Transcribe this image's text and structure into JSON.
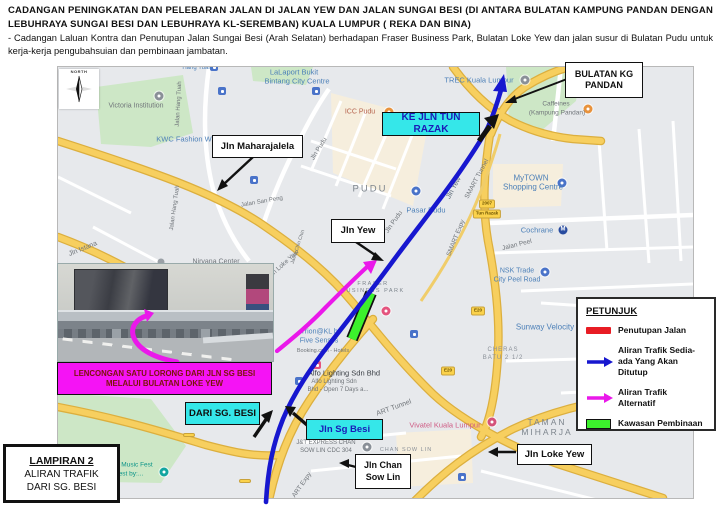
{
  "header": {
    "title": "CADANGAN PENINGKATAN DAN PELEBARAN JALAN DI JALAN YEW DAN JALAN SUNGAI BESI (DI ANTARA BULATAN KAMPUNG PANDAN DENGAN LEBUHRAYA SUNGAI BESI DAN LEBUHRAYA KL-SEREMBAN) KUALA LUMPUR ( REKA DAN BINA)",
    "subtitle": "- Cadangan Laluan Kontra dan Penutupan Jalan Sungai Besi (Arah Selatan) berhadapan Fraser Business Park, Bulatan Loke Yew dan jalan susur di Bulatan Pudu untuk kerja-kerja pengubahsuian dan pembinaan jambatan."
  },
  "callouts": {
    "bulatan_kg_pandan_l1": "BULATAN KG",
    "bulatan_kg_pandan_l2": "PANDAN",
    "ke_jln_tun_razak": "KE JLN TUN RAZAK",
    "jln_maharajalela": "Jln Maharajalela",
    "jln_yew": "Jln Yew",
    "lencongan_l1": "LENCONGAN SATU LORONG DARI JLN SG BESI",
    "lencongan_l2": "MELALUI BULATAN LOKE YEW",
    "dari_sg_besi": "DARI SG. BESI",
    "jln_sg_besi": "Jln Sg Besi",
    "jln_chan_sow_lin_l1": "Jln Chan",
    "jln_chan_sow_lin_l2": "Sow Lin",
    "jln_loke_yew": "Jln Loke Yew"
  },
  "legend": {
    "title": "PETUNJUK",
    "items": [
      {
        "symbol": "red-bar",
        "label": "Penutupan Jalan",
        "color": "#e81c24"
      },
      {
        "symbol": "blue-arrow",
        "label": "Aliran Trafik Sedia-ada Yang Akan Ditutup",
        "color": "#1717cf"
      },
      {
        "symbol": "magenta-arrow",
        "label": "Aliran Trafik Alternatif",
        "color": "#ea18ea"
      },
      {
        "symbol": "green-box",
        "label": "Kawasan Pembinaan",
        "color": "#3cf12c"
      }
    ]
  },
  "annex": {
    "line1": "LAMPIRAN 2",
    "line2": "ALIRAN TRAFIK",
    "line3": "DARI SG. BESI"
  },
  "compass": {
    "label": "NORTH"
  },
  "colors": {
    "accent_cyan": "#35e7e9",
    "accent_magenta": "#f513f5",
    "route_blue": "#1717cf",
    "route_magenta": "#ea18ea",
    "construction_green": "#3cf12c",
    "closure_red": "#e81c24"
  },
  "map_labels": [
    {
      "t": "Victoria Institution",
      "x": 135,
      "y": 105
    },
    {
      "t": "LaLaport Bukit",
      "x": 293,
      "y": 71,
      "c": "#4d80b8",
      "s": 7.5
    },
    {
      "t": "Bintang City Centre",
      "x": 296,
      "y": 80,
      "c": "#4d80b8",
      "s": 7.5
    },
    {
      "t": "Hang Tuah",
      "x": 196,
      "y": 67,
      "c": "#4d80b8",
      "s": 6
    },
    {
      "t": "KWC Fashion W",
      "x": 183,
      "y": 138,
      "c": "#4d80b8",
      "s": 7.5
    },
    {
      "t": "Jalan Hang Tuah",
      "x": 178,
      "y": 103,
      "r": -87,
      "s": 6
    },
    {
      "t": "Jalan Hang Tuah",
      "x": 174,
      "y": 207,
      "r": -82,
      "s": 6
    },
    {
      "t": "Jln Pudu",
      "x": 318,
      "y": 148,
      "r": -58,
      "s": 6.5
    },
    {
      "t": "Jln Pudu",
      "x": 393,
      "y": 221,
      "r": -55,
      "s": 6.5
    },
    {
      "t": "Jalan San Peng",
      "x": 261,
      "y": 201,
      "r": -10,
      "s": 6
    },
    {
      "t": "PUDU",
      "x": 369,
      "y": 188,
      "c": "#7d858d",
      "s": 9.5,
      "ls": 2
    },
    {
      "t": "Pasar Pudu",
      "x": 425,
      "y": 209,
      "c": "#4d80b8",
      "s": 7.5
    },
    {
      "t": "ICC Pudu",
      "x": 359,
      "y": 111,
      "c": "#b5624c",
      "s": 7
    },
    {
      "t": "Jln Yew",
      "x": 453,
      "y": 187,
      "r": -62,
      "s": 7,
      "c": "#5d6b78"
    },
    {
      "t": "SMART Tunnel",
      "x": 476,
      "y": 178,
      "r": -62,
      "s": 6.5
    },
    {
      "t": "SMART Expy",
      "x": 455,
      "y": 237,
      "r": -68,
      "s": 6.5
    },
    {
      "t": "TREC Kuala Lumpur",
      "x": 478,
      "y": 79,
      "c": "#4d80b8",
      "s": 7.5
    },
    {
      "t": "Caffeines",
      "x": 555,
      "y": 103,
      "s": 6.5
    },
    {
      "t": "(Kampung Pandan)",
      "x": 556,
      "y": 112,
      "s": 6.5
    },
    {
      "t": "MyTOWN",
      "x": 530,
      "y": 177,
      "c": "#4d80b8",
      "s": 8
    },
    {
      "t": "Shopping Centre",
      "x": 532,
      "y": 186,
      "c": "#4d80b8",
      "s": 8
    },
    {
      "t": "Cochrane",
      "x": 536,
      "y": 229,
      "c": "#4d80b8",
      "s": 7.5
    },
    {
      "t": "Jalan Peel",
      "x": 516,
      "y": 244,
      "r": -14,
      "s": 6.5
    },
    {
      "t": "NSK Trade",
      "x": 516,
      "y": 270,
      "c": "#4d80b8",
      "s": 7
    },
    {
      "t": "City Peel Road",
      "x": 516,
      "y": 279,
      "c": "#4d80b8",
      "s": 7
    },
    {
      "t": "Sunway Velocity",
      "x": 544,
      "y": 326,
      "c": "#4d80b8",
      "s": 8
    },
    {
      "t": "CHERAS",
      "x": 502,
      "y": 349,
      "c": "#8a9098",
      "s": 6,
      "ls": 1
    },
    {
      "t": "BATU 2 1/2",
      "x": 502,
      "y": 357,
      "c": "#8a9098",
      "s": 6,
      "ls": 1
    },
    {
      "t": "TAMAN",
      "x": 546,
      "y": 421,
      "c": "#7d858d",
      "s": 8.5,
      "ls": 2
    },
    {
      "t": "MIHARJA",
      "x": 546,
      "y": 431,
      "c": "#7d858d",
      "s": 8.5,
      "ls": 2
    },
    {
      "t": "Vivatel Kuala Lumpur",
      "x": 444,
      "y": 424,
      "c": "#cf5b84",
      "s": 7.5
    },
    {
      "t": "J&T EXPRESS CHAN",
      "x": 325,
      "y": 442,
      "s": 6
    },
    {
      "t": "SOW LIN CDC 304",
      "x": 325,
      "y": 450,
      "s": 6
    },
    {
      "t": "CHAN SOW LIN",
      "x": 405,
      "y": 449,
      "c": "#8a9098",
      "s": 5.5,
      "ls": 1
    },
    {
      "t": "Jln Istana",
      "x": 82,
      "y": 248,
      "r": -22,
      "s": 7
    },
    {
      "t": "Jln Loke Yew",
      "x": 283,
      "y": 263,
      "r": -42,
      "s": 6.5
    },
    {
      "t": "Jalan Chin Chin",
      "x": 297,
      "y": 246,
      "r": -72,
      "s": 5
    },
    {
      "t": "Nirvana Center",
      "x": 215,
      "y": 261,
      "s": 7
    },
    {
      "t": "FRASER",
      "x": 372,
      "y": 283,
      "c": "#7d858d",
      "s": 5.5,
      "ls": 1.5
    },
    {
      "t": "BUSINESS PARK",
      "x": 372,
      "y": 290,
      "c": "#7d858d",
      "s": 5.5,
      "ls": 1.5
    },
    {
      "t": "Trion@KL by",
      "x": 320,
      "y": 331,
      "c": "#4d80b8",
      "s": 7
    },
    {
      "t": "Five Senses",
      "x": 318,
      "y": 340,
      "c": "#4d80b8",
      "s": 7
    },
    {
      "t": "Booking.com - Hotels",
      "x": 322,
      "y": 350,
      "s": 5.5
    },
    {
      "t": "Alfo Lighting Sdn Bhd",
      "x": 343,
      "y": 372,
      "c": "#3a3f45",
      "s": 7.5
    },
    {
      "t": "Alfo Lighting Sdn",
      "x": 333,
      "y": 381,
      "s": 6
    },
    {
      "t": "Bhd - Open 7 Days a...",
      "x": 337,
      "y": 389,
      "s": 6
    },
    {
      "t": "ART Tunnel",
      "x": 393,
      "y": 407,
      "r": -20,
      "s": 7
    },
    {
      "t": "ART Expy",
      "x": 301,
      "y": 484,
      "r": -55,
      "s": 6.5
    },
    {
      "t": "Music Fest",
      "x": 136,
      "y": 464,
      "c": "#0c9488",
      "s": 6.5
    },
    {
      "t": "Fest by:...",
      "x": 128,
      "y": 473,
      "c": "#0c9488",
      "s": 6.5
    }
  ],
  "pois": [
    {
      "kind": "pin",
      "x": 158,
      "y": 95,
      "color": "#8a9098",
      "name": "victoria-pin"
    },
    {
      "kind": "sq",
      "x": 221,
      "y": 90,
      "color": "#4a73c9",
      "name": "transit-icon"
    },
    {
      "kind": "sq",
      "x": 213,
      "y": 66,
      "color": "#4a73c9",
      "name": "transit-icon"
    },
    {
      "kind": "sq",
      "x": 315,
      "y": 90,
      "color": "#4a73c9",
      "name": "transit-icon"
    },
    {
      "kind": "pin",
      "x": 388,
      "y": 111,
      "color": "#e8923c",
      "name": "icc-pudu-pin"
    },
    {
      "kind": "sq",
      "x": 253,
      "y": 179,
      "color": "#4a73c9",
      "name": "transit-icon"
    },
    {
      "kind": "pin",
      "x": 415,
      "y": 190,
      "color": "#4a73c9",
      "name": "pasar-pudu-pin"
    },
    {
      "kind": "pin",
      "x": 524,
      "y": 79,
      "color": "#8a9098",
      "name": "trec-pin"
    },
    {
      "kind": "pin",
      "x": 587,
      "y": 108,
      "color": "#e8923c",
      "name": "caffeines-pin"
    },
    {
      "kind": "pin",
      "x": 561,
      "y": 182,
      "color": "#4a73c9",
      "name": "mytown-pin"
    },
    {
      "kind": "metro",
      "x": 562,
      "y": 229,
      "color": "#274b9f",
      "name": "cochrane-metro-icon"
    },
    {
      "kind": "pin",
      "x": 544,
      "y": 271,
      "color": "#4a73c9",
      "name": "nsk-pin"
    },
    {
      "kind": "pin",
      "x": 385,
      "y": 310,
      "color": "#e4547e",
      "name": "fraser-pin"
    },
    {
      "kind": "sq",
      "x": 413,
      "y": 333,
      "color": "#4a73c9",
      "name": "transit-icon"
    },
    {
      "kind": "sq",
      "x": 316,
      "y": 364,
      "color": "#e4547e",
      "name": "alfo-poi-icon"
    },
    {
      "kind": "sq",
      "x": 298,
      "y": 380,
      "color": "#4a73c9",
      "name": "transit-icon"
    },
    {
      "kind": "pin",
      "x": 491,
      "y": 421,
      "color": "#d4527a",
      "name": "vivatel-pin"
    },
    {
      "kind": "pin",
      "x": 366,
      "y": 446,
      "color": "#8a9098",
      "name": "jnt-pin"
    },
    {
      "kind": "pin",
      "x": 163,
      "y": 471,
      "color": "#12a5a0",
      "name": "music-fest-pin"
    },
    {
      "kind": "sq",
      "x": 461,
      "y": 476,
      "color": "#4a73c9",
      "name": "transit-icon"
    },
    {
      "kind": "dot",
      "x": 160,
      "y": 261,
      "color": "#9aa0a6",
      "name": "nirvana-icon"
    },
    {
      "kind": "shield",
      "x": 477,
      "y": 310,
      "text": "E20",
      "name": "route-shield"
    },
    {
      "kind": "shield",
      "x": 447,
      "y": 370,
      "text": "E20",
      "name": "route-shield"
    },
    {
      "kind": "shield",
      "x": 188,
      "y": 434,
      "text": "",
      "name": "route-shield"
    },
    {
      "kind": "shield",
      "x": 244,
      "y": 480,
      "text": "",
      "name": "route-shield"
    },
    {
      "kind": "shield",
      "x": 486,
      "y": 203,
      "text": "2007",
      "name": "route-shield"
    },
    {
      "kind": "shield",
      "x": 486,
      "y": 213,
      "text": "Tun Razak",
      "name": "route-shield"
    }
  ]
}
